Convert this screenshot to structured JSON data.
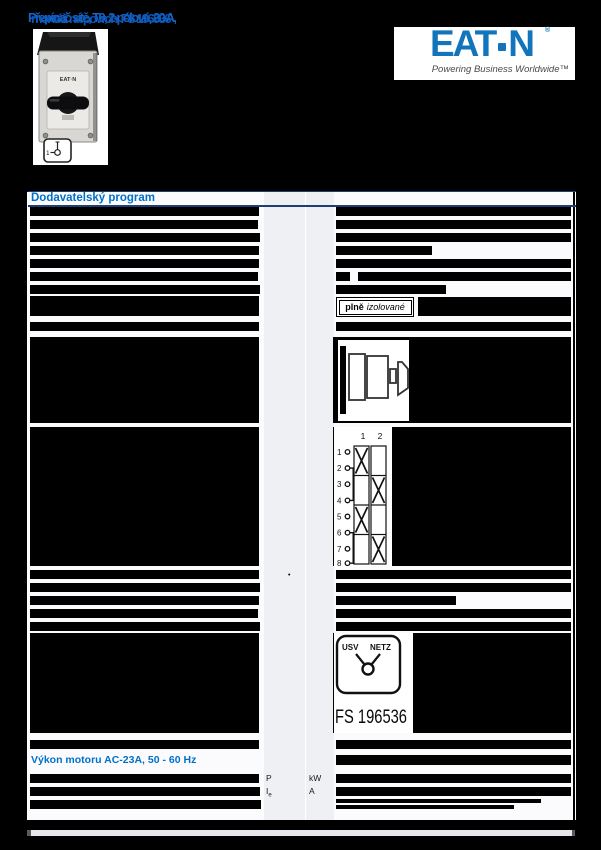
{
  "colors": {
    "accent_blue": "#0070C8",
    "eaton_blue": "#1274BA",
    "page_bg": "#000000"
  },
  "header": {
    "garbled_title": {
      "layer_a": "Přepínač sítě, T0, 2-pólové, 20 A,",
      "layer_b": "montáž na povrch, FS 196536"
    },
    "logo": {
      "wordmark_left": "EAT",
      "wordmark_right": "N",
      "registered": "®",
      "tagline": "Powering Business Worldwide™"
    }
  },
  "product": {
    "brand_mark": "EAT·N",
    "position_diagram": {
      "label": "1"
    }
  },
  "table": {
    "title": "Dodavatelský program",
    "motor_title": "Výkon motoru AC-23A, 50 - 60 Hz",
    "footnote_marker": "•",
    "units": {
      "p_symbol": "P",
      "p_unit": "kW",
      "ie_symbol": "I",
      "ie_sub": "e",
      "ie_unit": "A"
    }
  },
  "badge": {
    "bold": "plně",
    "italic": "izolované"
  },
  "contact_diagram": {
    "columns": [
      "1",
      "2"
    ],
    "terminals": [
      "1",
      "2",
      "3",
      "4",
      "5",
      "6",
      "7",
      "8"
    ],
    "bridges": [
      "2-4",
      "6-8"
    ],
    "x_pattern": [
      [
        "1"
      ],
      [
        "2"
      ],
      [
        "1"
      ],
      [
        "2"
      ]
    ]
  },
  "changeover": {
    "left_label": "USV",
    "right_label": "NETZ",
    "code": "FS 196536"
  }
}
